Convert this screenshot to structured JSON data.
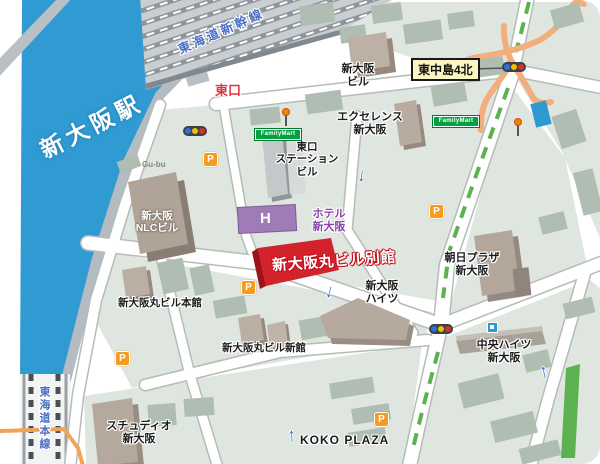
{
  "station": {
    "label": "新大阪駅"
  },
  "railways": {
    "shinkansen_label": "東海道新幹線",
    "main_line_label": "東海道本線"
  },
  "landmarks": {
    "east_exit": "東口",
    "intersection_sign": "東中島4北",
    "shin_osaka_bldg": {
      "line1": "新大阪",
      "line2": "ビル"
    },
    "excellence": {
      "line1": "エクセレンス",
      "line2": "新大阪"
    },
    "east_exit_station_bldg": {
      "line1": "東口",
      "line2": "ステーション",
      "line3": "ビル"
    },
    "hotel": {
      "mark": "H",
      "line1": "ホテル",
      "line2": "新大阪"
    },
    "nlc": {
      "line1": "新大阪",
      "line2": "NLCビル"
    },
    "maru_bekkan": "新大阪丸ビル別館",
    "maru_honkan": "新大阪丸ビル本館",
    "maru_shinkan": "新大阪丸ビル新館",
    "heights": {
      "line1": "新大阪",
      "line2": "ハイツ"
    },
    "asahi_plaza": {
      "line1": "朝日プラザ",
      "line2": "新大阪"
    },
    "chuo_heights": {
      "line1": "中央ハイツ",
      "line2": "新大阪"
    },
    "studio": {
      "line1": "スチュディオ",
      "line2": "新大阪"
    },
    "koko_plaza": "KOKO  PLAZA",
    "shop": "Gu-bu"
  },
  "icons": {
    "parking": "P",
    "familymart": "FamilyMart",
    "one_way_up": "↑",
    "one_way_down": "↓"
  },
  "colors": {
    "station_blue": "#2f9bd2",
    "highlight_red": "#d2232c",
    "familymart_green": "#00a33f",
    "median_green": "#5cb150",
    "parking_orange": "#f59b1e",
    "bridge_orange": "#f2ae7c",
    "hotel_purple": "#9f7cb8",
    "rail_text_blue": "#4a6fc3"
  }
}
